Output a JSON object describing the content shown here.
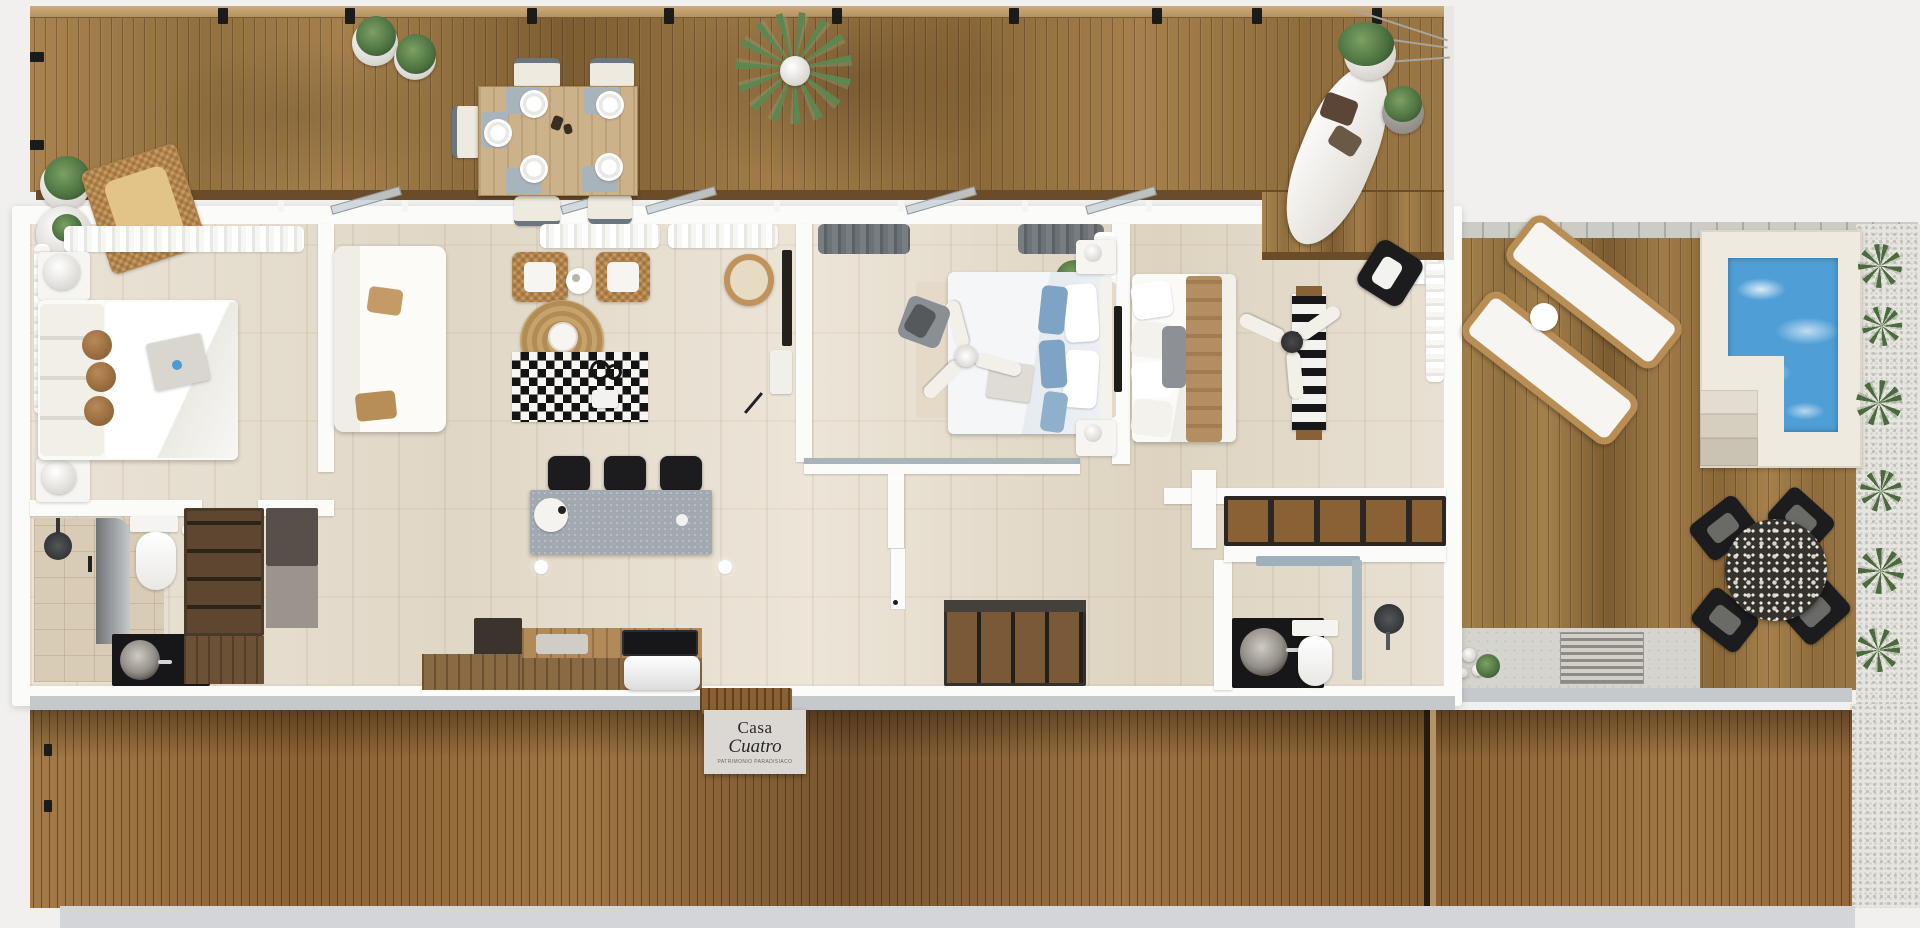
{
  "sign": {
    "line1": "Casa",
    "line2": "Cuatro",
    "tagline": "PATRIMONIO PARADISIACO"
  },
  "palette": {
    "background": "#f1f0ee",
    "wall_white": "#fbfbf9",
    "floor_stone": "#e7e0d2",
    "deck_wood": "#a07a4a",
    "roof_wood": "#9a7243",
    "pool_water": "#4f9fd6",
    "island_gray": "#a2a9b1",
    "wicker_tan": "#c89a62",
    "checker_black": "#141414",
    "concrete_gray": "#d6d4cf",
    "curtain_white": "#f6f6f3",
    "pillow_blue": "#7fa3c4",
    "pillow_brown": "#a4764a",
    "chair_black": "#1c1c1e",
    "plant_green": "#55784a"
  },
  "scene": {
    "type": "3d-floor-plan-render",
    "areas": [
      "top-terrace",
      "bedroom-1",
      "living-room",
      "kitchen",
      "hallway",
      "bedroom-2",
      "bedroom-3",
      "bathroom-1",
      "bathroom-2",
      "side-deck",
      "plunge-pool",
      "outdoor-dining",
      "roof-deck"
    ]
  }
}
